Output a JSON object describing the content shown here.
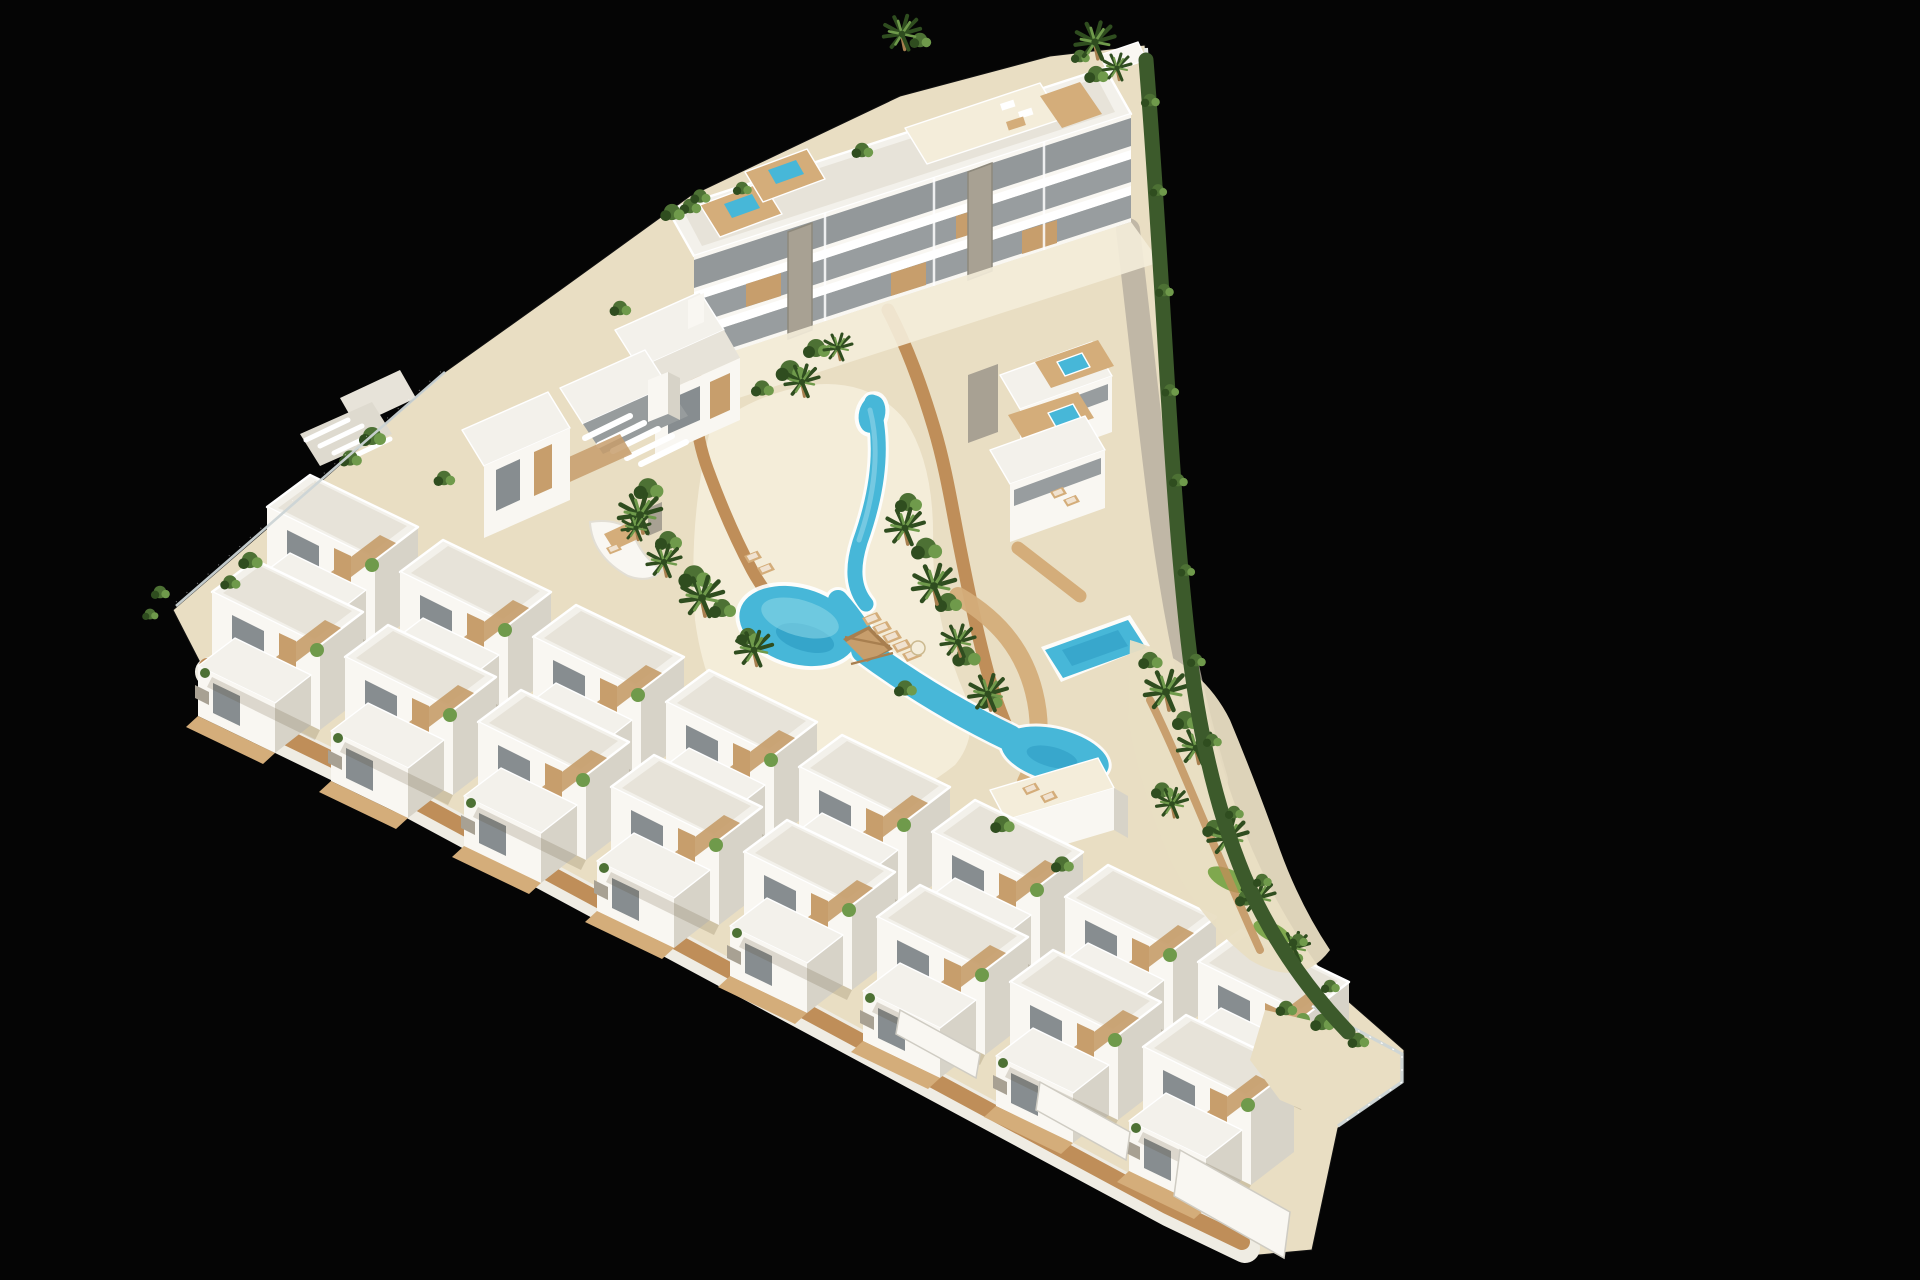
{
  "scene": {
    "type": "architectural-3d-render",
    "description": "Aerial axonometric 3D rendering of a white Mediterranean residential resort on a black background: a triangular plot with two staggered rows of boxy white villas with timber pergolas in the lower left, a strip of three-storey apartment blocks with rooftop plunge-pool terraces along the upper edge, stepped terrace houses with jacuzzi decks and a private pool on the right, and a central landscaped courtyard with a winding turquoise lagoon pool, sandy beaches, timber boardwalks, palm trees and a curved perimeter hedge.",
    "view": "aerial isometric",
    "time_of_day": "day",
    "background": "#050505"
  },
  "palette": {
    "bg": "#050505",
    "roofLight": "#f3f1eb",
    "roofInner": "#e7e3d9",
    "wallBright": "#f9f7f2",
    "wallShade": "#d7d3c8",
    "wallDark": "#bfbab0",
    "glass": "#878d90",
    "wood": "#c79e6c",
    "woodDark": "#a87f4f",
    "woodDeck": "#d4ad7a",
    "stone": "#a8a193",
    "sand": "#e9dec3",
    "beach": "#f4edda",
    "path": "#bf8e59",
    "poolBlue": "#47b7d8",
    "poolDeep": "#2e9dc4",
    "poolLight": "#8ed8e8",
    "green": "#4d7134",
    "greenDark": "#2f4d1f",
    "greenLight": "#6f9a4b",
    "lawn": "#7fa84e",
    "hedge": "#3c5a2b",
    "fence": "#cdd5d6"
  },
  "site": {
    "plot_shape": "triangular",
    "boundaries": {
      "northwest": "glass-panel fence with greenery",
      "east": "curved perimeter hedge with white wall near the apex",
      "southwest": "stepped villa terraces over timber boardwalk and white retaining walls"
    }
  },
  "buildings": {
    "apartment_block": {
      "label": "three-storey apartment slab",
      "floors": 3,
      "rooftop_plunge_pools": 2,
      "stone_clad_columns": 2,
      "roof_terrace_with_lounge": 1
    },
    "fins_house": {
      "label": "house with angled white roof fins"
    },
    "curved_terrace_duplex": {
      "label": "duplex with curved terrace and palm"
    },
    "townhouse_left": {
      "label": "two-storey townhouse with slatted pergola"
    },
    "terrace_houses_right": {
      "count": 3,
      "rooftop_jacuzzis": 2,
      "private_pool": 1
    },
    "villas_back_row": {
      "count": 8,
      "storeys": 2,
      "features": [
        "roof terraces",
        "timber pergola beams",
        "wood slat panels"
      ]
    },
    "villas_front_row": {
      "count": 8,
      "storeys": 2
    }
  },
  "amenities": {
    "lagoon_pool": {
      "style": "winding lagoon with beach entry",
      "color": "#47b7d8"
    },
    "wooden_bridge": 1,
    "sun_loungers": 8,
    "parasol": 1,
    "boardwalks": 3,
    "jacuzzis": 2,
    "private_pool": 1
  },
  "landscape": {
    "palm_trees": 20,
    "shrub_clusters": 34,
    "lawn_patches": 2,
    "sand_ground": true,
    "perimeter_hedge": "full east side"
  }
}
